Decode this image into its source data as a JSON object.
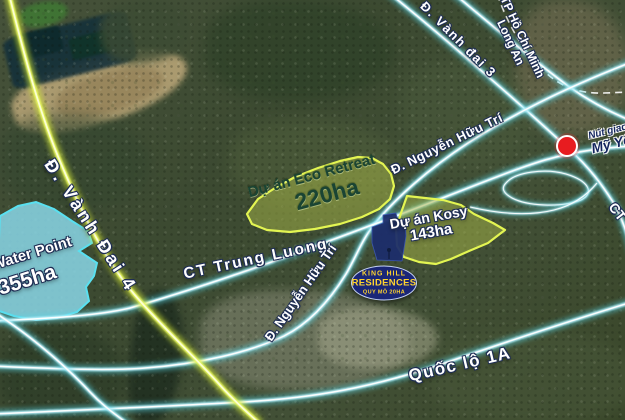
{
  "colors": {
    "road-cyan-glow": "#58d6e8",
    "road-cyan-mid": "#bdf2fc",
    "road-cyan-core": "#ffffff",
    "road-yellow-glow": "#cfe438",
    "road-yellow-mid": "#e9f763",
    "road-yellow-core": "#fcffd8",
    "area-green-fill": "rgba(163,178,70,0.52)",
    "area-green-stroke": "#e3f552",
    "area-label-green": "#1a4433",
    "water-fill": "rgba(137,215,231,0.85)",
    "water-stroke": "#59e0f0",
    "site-navy": "#1d2e6b",
    "badge-bg": "#1a2677",
    "badge-border": "#c7d4f5",
    "badge-text": "#ffd42e",
    "marker-red": "#e81c20",
    "boundary-white": "#ffffff"
  },
  "areas": {
    "water_point": {
      "name": "Water Point",
      "area": "355ha"
    },
    "eco_retreat": {
      "name": "Dự án Eco Retreat",
      "area": "220ha"
    },
    "kosy": {
      "name": "Dự án Kosy",
      "area": "143ha"
    }
  },
  "project": {
    "brand_top": "KING HILL",
    "brand_main": "RESIDENCES",
    "scale_label": "QUY MÔ 20HA"
  },
  "roads": {
    "vanh_dai_4": "Đ. Vành Đai 4",
    "vanh_dai_3": "Đ. Vành đai 3",
    "ct_trung_luong": "CT Trung Luong",
    "nguyen_huu_tri_upper": "Đ. Nguyễn Hữu Trí",
    "nguyen_huu_tri_lower": "Đ. Nguyễn Hữu Trí",
    "quoc_lo_1a": "Quốc lộ 1A",
    "ct_expressway_partial": "CT"
  },
  "boundary": {
    "region_north": "TP Hồ Chí Minh",
    "region_south": "Long An"
  },
  "junction": {
    "prefix": "Nút giao",
    "name": "Mỹ Yên"
  }
}
